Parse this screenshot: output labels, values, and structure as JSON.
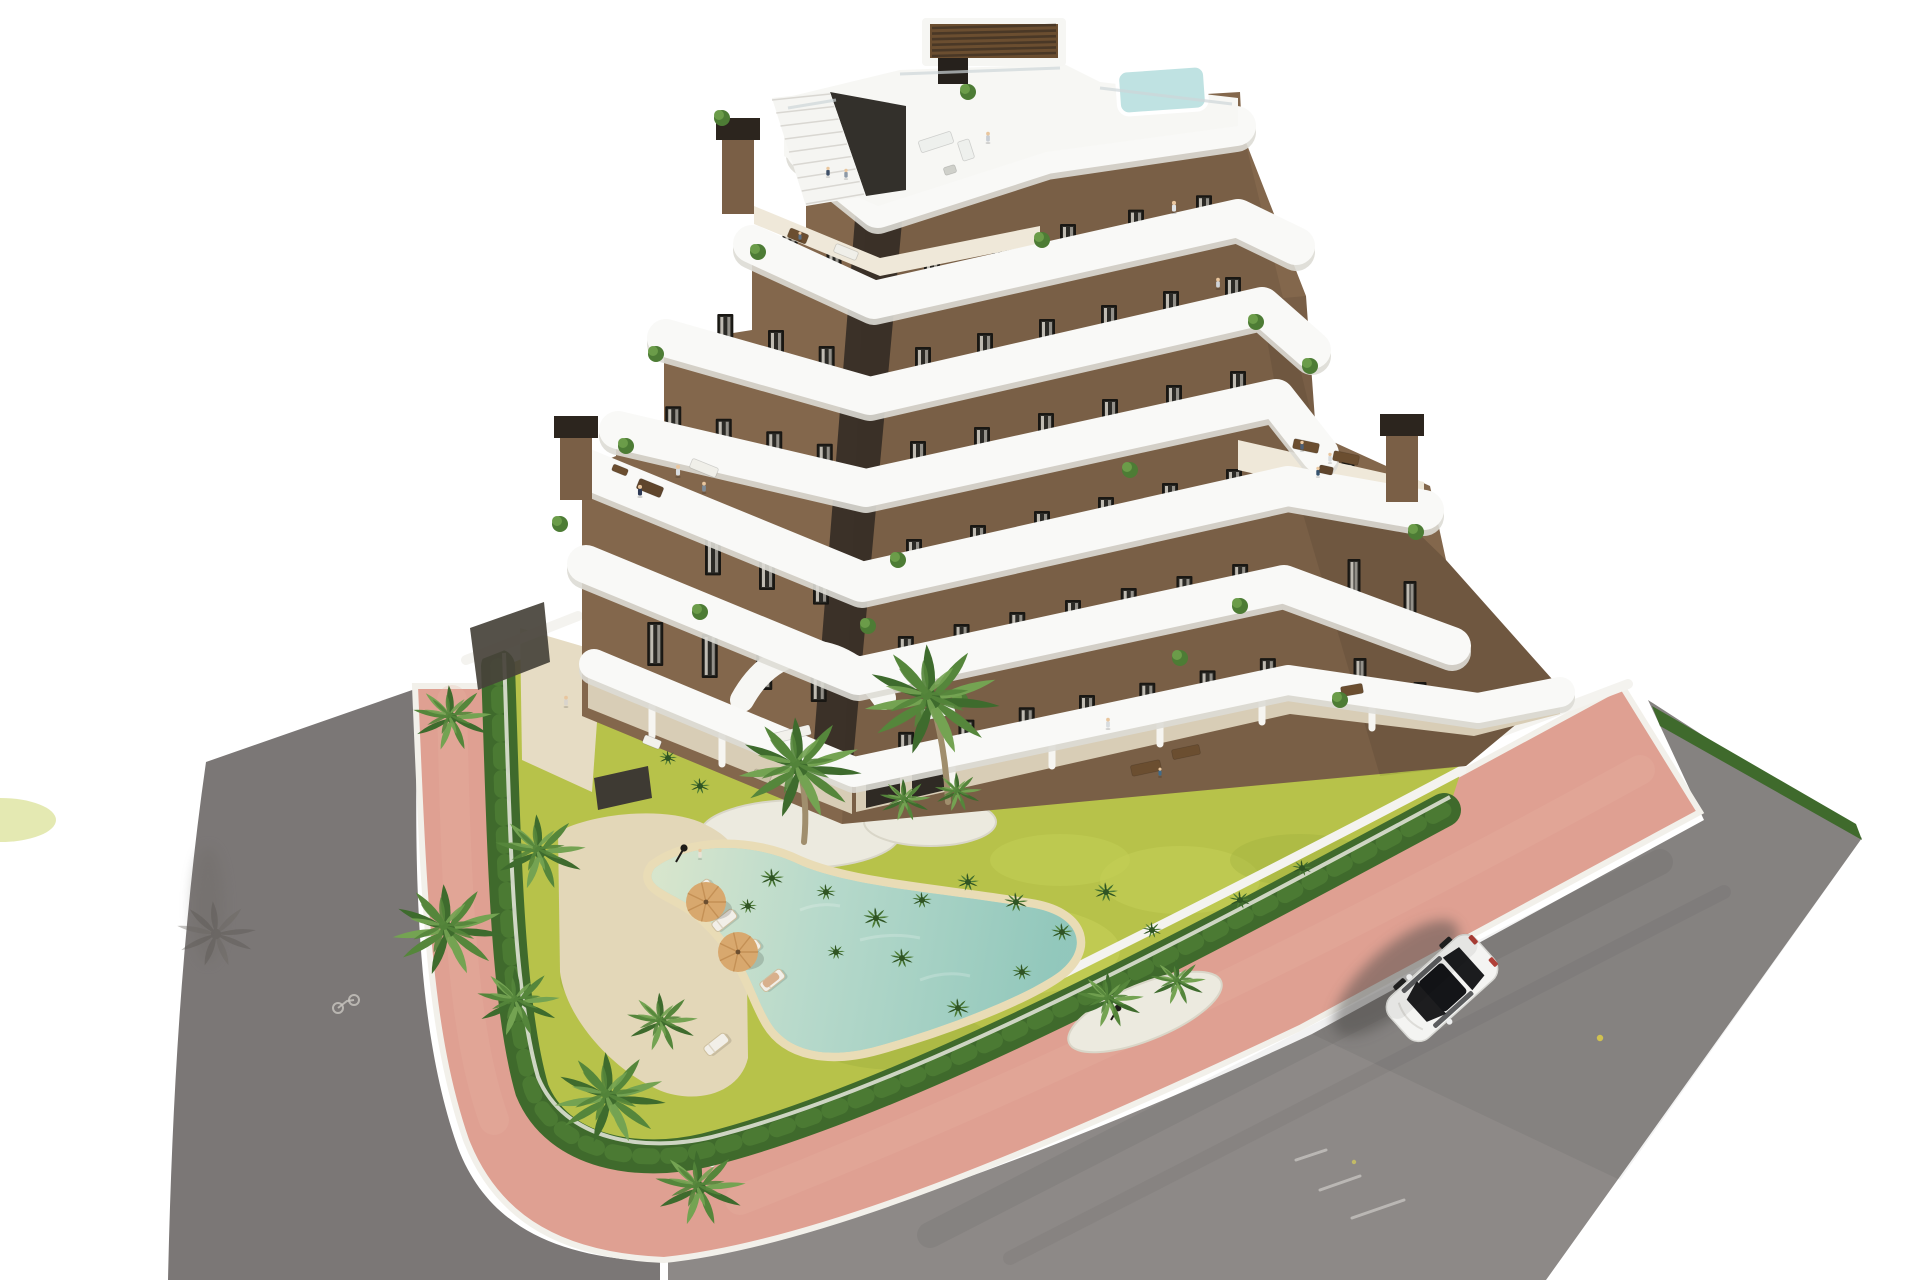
{
  "scene": {
    "type": "architectural-aerial-render",
    "description": "Aerial 3D rendering of a modern stepped apartment building with curved white balcony bands, brown facade, rooftop plunge pool, landscaped garden with free-form lagoon pool, palm trees, pink perimeter sidewalk, asphalt road and a single white car",
    "background": "#ffffff"
  },
  "palette": {
    "background": "#ffffff",
    "asphalt": "#8d8987",
    "asphalt_dark": "#7b7776",
    "sidewalk_pink": "#dfa092",
    "curb_white": "#f2f0ea",
    "lawn": "#b7c24a",
    "lawn_light": "#ccd65f",
    "lawn_dark": "#9aad3c",
    "hedge": "#3f6a2c",
    "hedge_light": "#5a8f3c",
    "gravel": "#eceadf",
    "sand_deck": "#e3d7b8",
    "pool_rim": "#e9dcb6",
    "pool_water": "#a7d3c9",
    "pool_beach": "#d9e4c9",
    "deck_beige": "#d8cdb6",
    "deck_light": "#efe8d9",
    "white_band": "#f9f9f7",
    "white_shade": "#dddbd5",
    "white_wall": "#f4f3ef",
    "facade": "#83674c",
    "facade_dark": "#644932",
    "window_frame": "#191713",
    "glass": "#2b2a26",
    "curtain": "#d9d5cb",
    "wood": "#6b4e30",
    "wood_dark": "#5f452c",
    "roof_pool": "#bfe2e2",
    "umbrella": "#d8a86e",
    "umbrella_dark": "#c49055",
    "palm_dark": "#3e6b2d",
    "palm_mid": "#55863b",
    "palm_light": "#74a352",
    "palm_trunk": "#a08e6d",
    "car_body": "#f4f4f2",
    "car_glass": "#1d1d1f",
    "people_skin": "#e9c69e"
  },
  "building": {
    "floors_visible": 7,
    "balcony_style": "curved white ribbon balconies",
    "facade_material": "brown stucco with dark framed windows",
    "chimneys": 3,
    "rooftop": {
      "plunge_pool": true,
      "pergola": true,
      "exterior_stair": true,
      "glass_balustrade": true
    },
    "large_terraces": 2,
    "people_visible": 17
  },
  "garden": {
    "pool_shape": "free-form lagoon with beach entry",
    "sun_loungers": 5,
    "umbrellas": 2,
    "lamp_posts": 2,
    "palm_trees_large": 13,
    "gravel_islands": 3,
    "hedge_border": true,
    "lawn": "yellow-green meadow"
  },
  "street": {
    "sidewalk": "pink paved walkway with white curbs",
    "road": "gray asphalt",
    "vehicles": [
      {
        "type": "car",
        "color": "white",
        "heading": "southwest"
      }
    ]
  }
}
